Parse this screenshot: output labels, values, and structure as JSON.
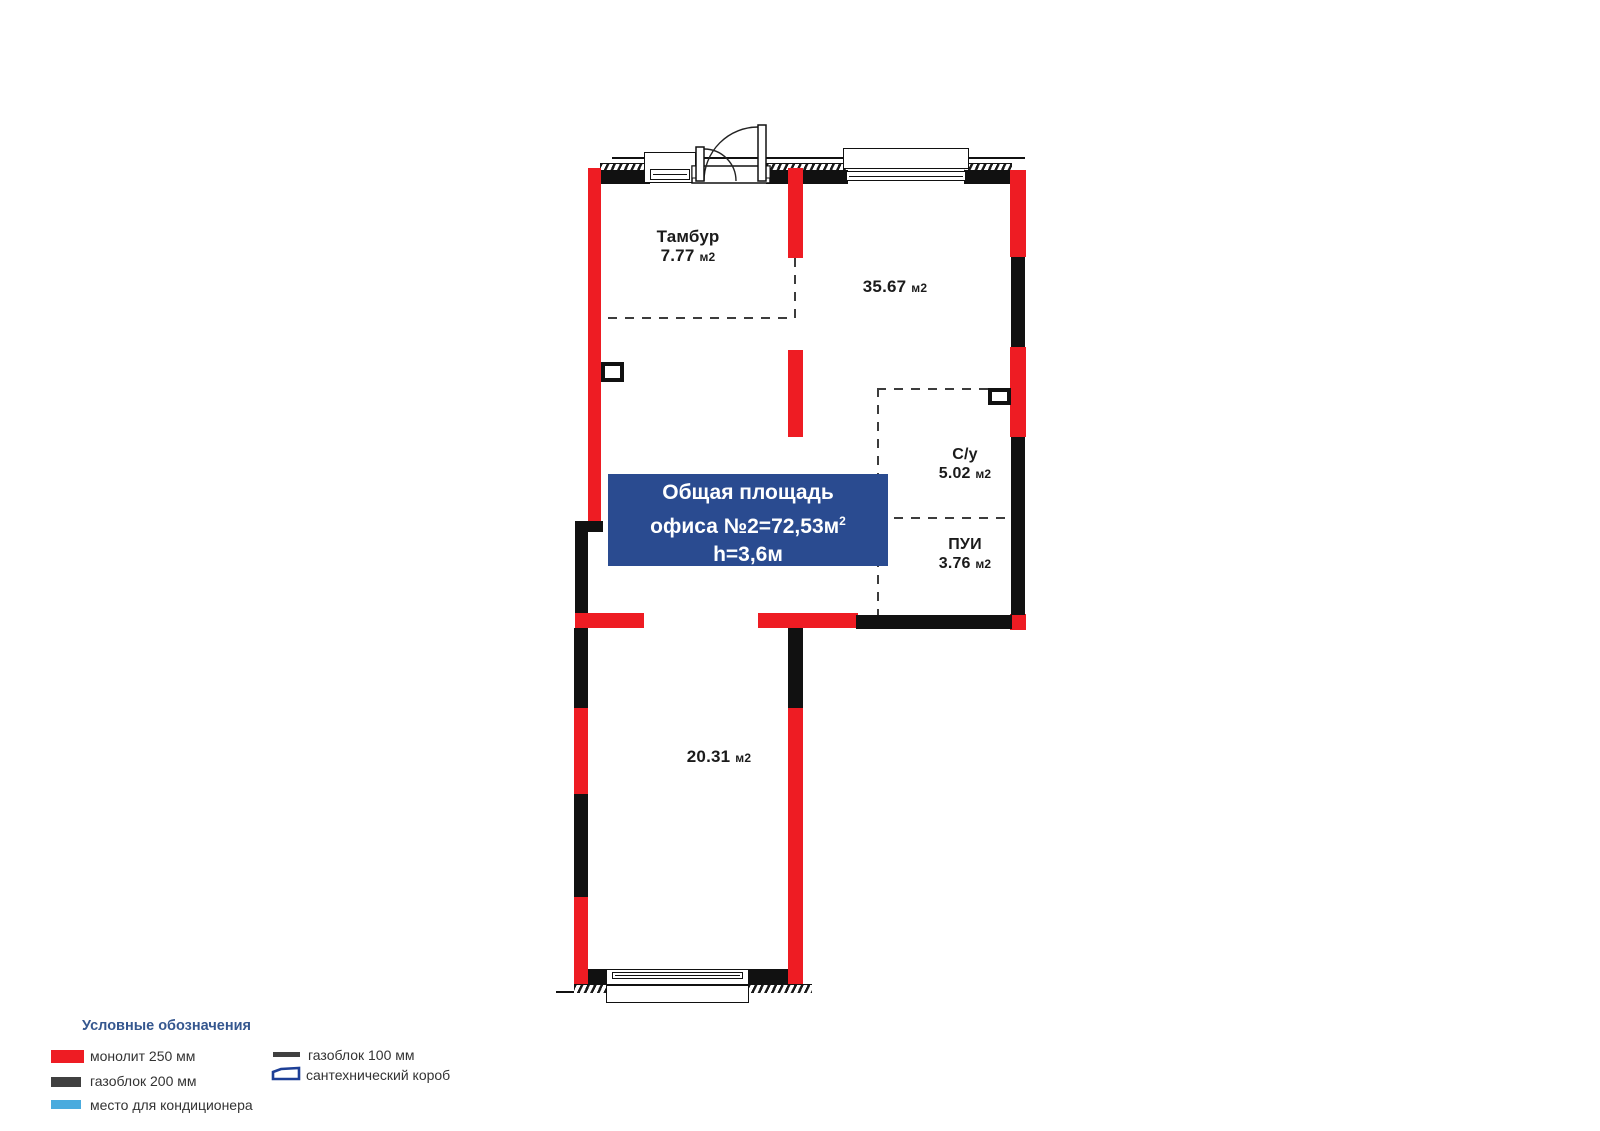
{
  "plan": {
    "info_box": {
      "line1": "Общая площадь",
      "line2": "офиса №2=72,53м",
      "line2_sup": "2",
      "line3": "h=3,6м"
    },
    "rooms": {
      "tambur": {
        "name": "Тамбур",
        "area": "7.77",
        "unit": "м2"
      },
      "hall": {
        "area": "35.67",
        "unit": "м2"
      },
      "su": {
        "name": "С/у",
        "area": "5.02",
        "unit": "м2"
      },
      "pui": {
        "name": "ПУИ",
        "area": "3.76",
        "unit": "м2"
      },
      "lower": {
        "area": "20.31",
        "unit": "м2"
      }
    }
  },
  "legend": {
    "title": "Условные обозначения",
    "items": [
      {
        "id": "monolith",
        "label": "монолит 250 мм"
      },
      {
        "id": "gasblock200",
        "label": "газоблок 200 мм"
      },
      {
        "id": "ac",
        "label": "место для кондиционера"
      },
      {
        "id": "gasblock100",
        "label": "газоблок 100 мм"
      },
      {
        "id": "sanbox",
        "label": "сантехнический короб"
      }
    ]
  },
  "colors": {
    "monolith_red": "#ee1c23",
    "gasblock_dark": "#111111",
    "ac_blue": "#4aabde",
    "sanbox_blue": "#1d3f96",
    "info_box_blue": "#2a4b90",
    "legend_title_blue": "#35578f",
    "label_dark": "#1b1b1b"
  }
}
